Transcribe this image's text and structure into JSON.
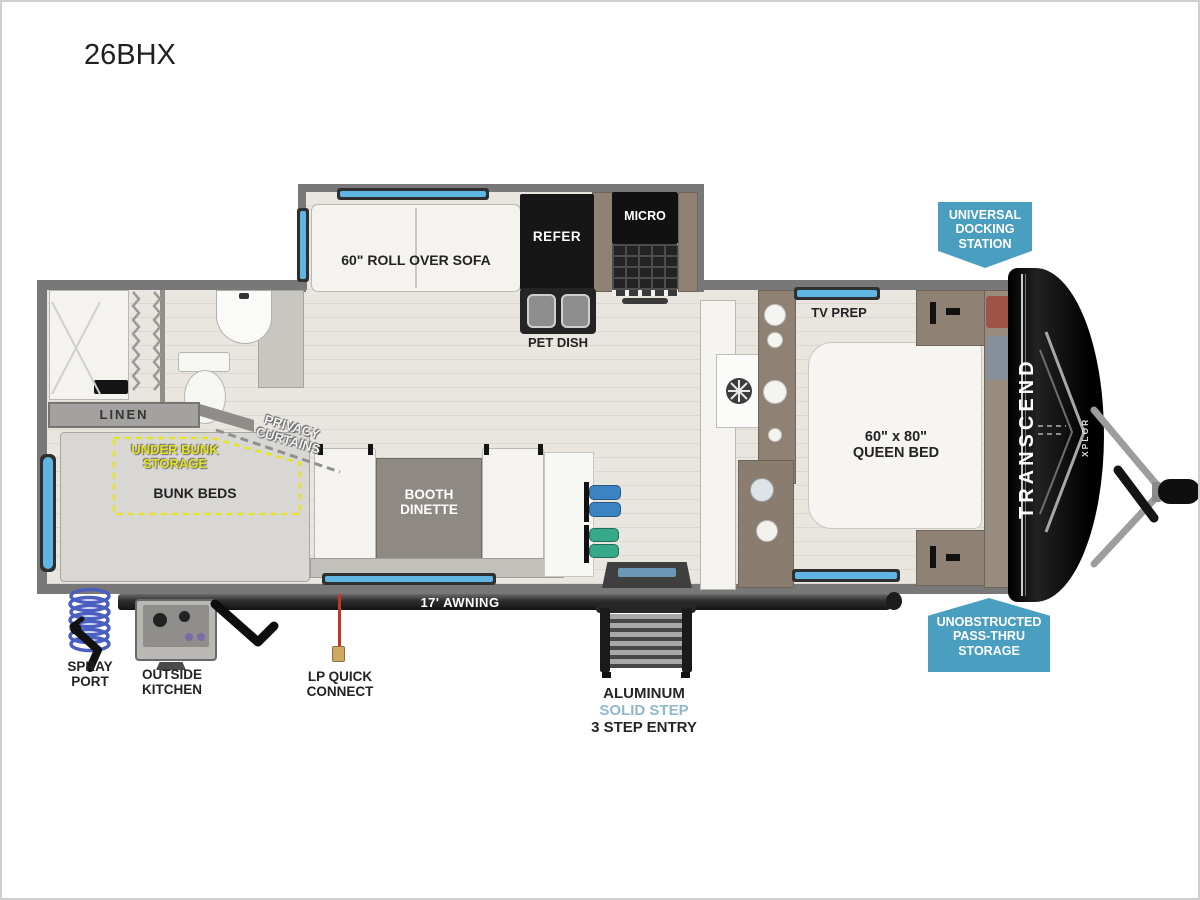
{
  "title": "26BHX",
  "labels": {
    "sofa": "60\" ROLL OVER SOFA",
    "refer": "REFER",
    "micro": "MICRO",
    "pet_dish": "PET DISH",
    "linen": "LINEN",
    "privacy_curtains": "PRIVACY\nCURTAINS",
    "under_bunk_storage": "UNDER BUNK\nSTORAGE",
    "bunk_beds": "BUNK BEDS",
    "booth_dinette": "BOOTH\nDINETTE",
    "tv_prep": "TV PREP",
    "queen_bed": "60\" x 80\"\nQUEEN BED",
    "awning": "17' AWNING",
    "spray_port": "SPRAY\nPORT",
    "outside_kitchen": "OUTSIDE\nKITCHEN",
    "lp_quick_connect": "LP QUICK\nCONNECT",
    "step_material": "ALUMINUM",
    "step_type": "SOLID STEP",
    "step_entry": "3 STEP ENTRY"
  },
  "badges": {
    "docking_station": "UNIVERSAL\nDOCKING\nSTATION",
    "pass_thru": "UNOBSTRUCTED\nPASS-THRU\nSTORAGE"
  },
  "brand": {
    "name": "TRANSCEND",
    "series": "XPLOR"
  },
  "colors": {
    "badge_blue": "#4a9fc0",
    "window_blue": "#5fb6e2",
    "storage_highlight_yellow": "#e6e422",
    "lp_red": "#c43527",
    "step_accent_blue": "#8fb8cc",
    "floor": "#e8e5df",
    "wall_gray": "#787878",
    "front_cap_black": "#151515"
  }
}
